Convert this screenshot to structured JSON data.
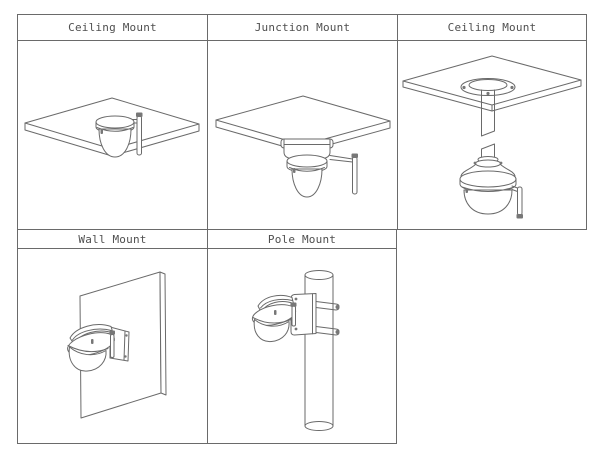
{
  "colors": {
    "background": "#ffffff",
    "line": "#6a6a6a",
    "text": "#4f4f4f"
  },
  "cells": [
    {
      "label": "Ceiling Mount",
      "illustration": "dome-camera-ceiling-mount"
    },
    {
      "label": "Junction Mount",
      "illustration": "dome-camera-junction-box-mount"
    },
    {
      "label": "Ceiling Mount",
      "illustration": "dome-camera-pendant-ceiling-mount"
    },
    {
      "label": "Wall Mount",
      "illustration": "dome-camera-wall-mount"
    },
    {
      "label": "Pole Mount",
      "illustration": "dome-camera-pole-mount"
    }
  ]
}
